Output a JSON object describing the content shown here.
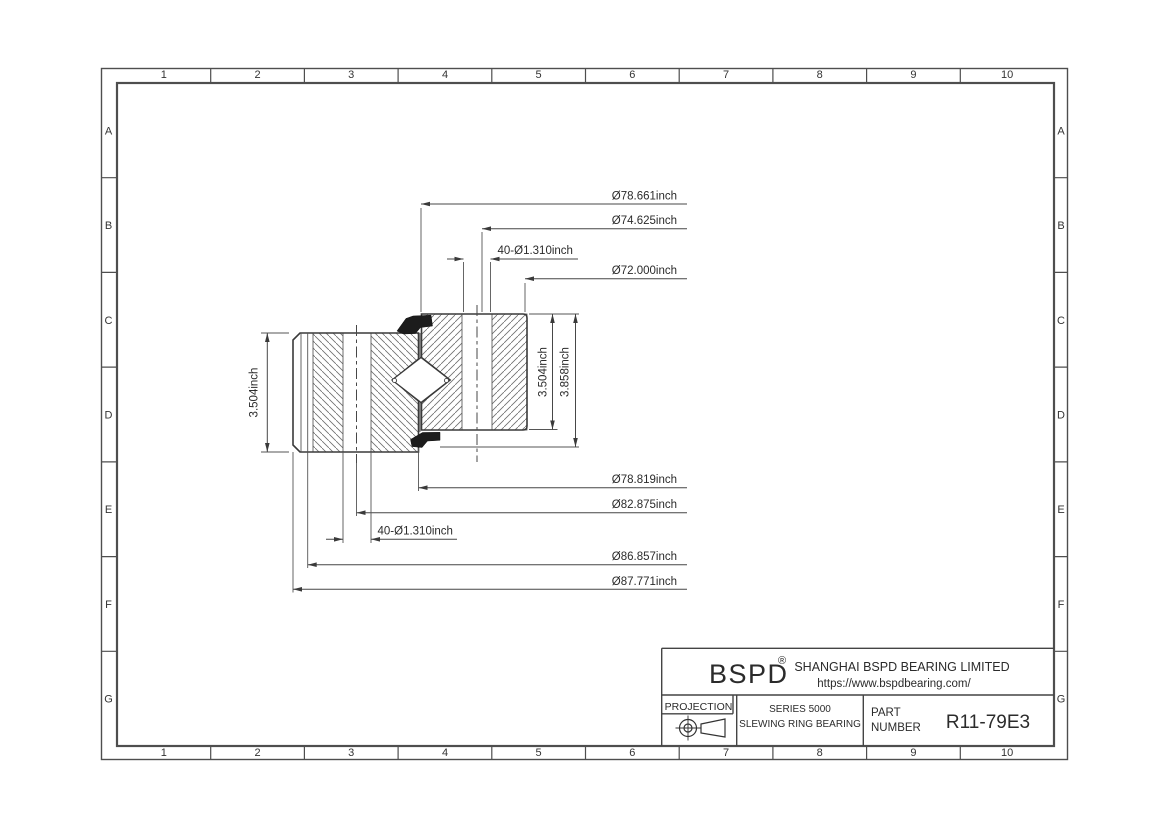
{
  "sheet": {
    "column_labels": [
      "1",
      "2",
      "3",
      "4",
      "5",
      "6",
      "7",
      "8",
      "9",
      "10"
    ],
    "row_labels": [
      "A",
      "B",
      "C",
      "D",
      "E",
      "F",
      "G"
    ]
  },
  "dimensions": {
    "dia_seal_outer": "Ø78.661inch",
    "dia_inner_bolt_circle": "Ø74.625inch",
    "inner_holes": "40-Ø1.310inch",
    "dia_bore": "Ø72.000inch",
    "dia_outer_inner": "Ø78.819inch",
    "dia_outer_bolt_circle": "Ø82.875inch",
    "outer_holes": "40-Ø1.310inch",
    "dia_outer_step": "Ø86.857inch",
    "dia_outer_od": "Ø87.771inch",
    "height_outer_ring": "3.504inch",
    "height_inner_ring": "3.504inch",
    "height_total": "3.858inch"
  },
  "title_block": {
    "logo": "BSPD",
    "registered": "®",
    "company": "SHANGHAI BSPD BEARING LIMITED",
    "website": "https://www.bspdbearing.com/",
    "projection_label": "PROJECTION",
    "series_line1": "SERIES 5000",
    "series_line2": "SLEWING RING BEARING",
    "part_label_line1": "PART",
    "part_label_line2": "NUMBER",
    "part_number": "R11-79E3"
  }
}
